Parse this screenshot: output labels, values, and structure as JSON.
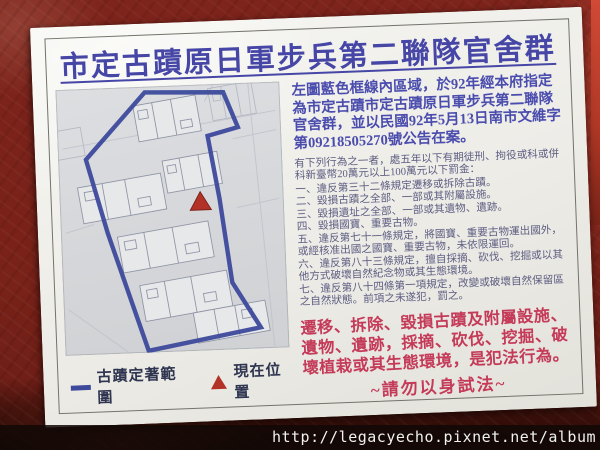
{
  "sign": {
    "title": "市定古蹟原日軍步兵第二聯隊官舍群",
    "intro": "左圖藍色框線內區域，於92年經本府指定為市定古蹟市定古蹟原日軍步兵第二聯隊官舍群，並以民國92年5月13日南市文維字第09218505270號公告在案。",
    "penalty_intro": "有下列行為之一者，處五年以下有期徒刑、拘役或科或併科新臺幣20萬元以上100萬元以下罰金：",
    "penalty_items": [
      "一、違反第三十二條規定遷移或拆除古蹟。",
      "二、毀損古蹟之全部、一部或其附屬設施。",
      "三、毀損遺址之全部、一部或其遺物、遺跡。",
      "四、毀損國寶、重要古物。",
      "五、違反第七十一條規定，將國寶、重要古物運出國外，或經核准出國之國寶、重要古物，未依限運回。",
      "六、違反第八十三條規定，擅自採摘、砍伐、挖掘或以其他方式破壞自然紀念物或其生態環境。",
      "七、違反第八十四條第一項規定，改變或破壞自然保留區之自然狀態。前項之未遂犯，罰之。"
    ],
    "warning": "遷移、拆除、毀損古蹟及附屬設施、遺物、遺跡，採摘、砍伐、挖掘、破壞植栽或其生態環境，是犯法行為。",
    "warning_tail": "~請勿以身試法~",
    "legend": {
      "boundary_label": "古蹟定著範圍",
      "position_label": "現在位置"
    },
    "map": {
      "boundary_symbol": "blue-boundary-line",
      "position_symbol": "red-triangle-marker"
    },
    "colors": {
      "title_blue": "#4646a6",
      "intro_blue": "#4b4dae",
      "penalty_gray_indigo": "#5d5d82",
      "warning_red": "#c43a58",
      "boundary_blue": "#3d4a9c",
      "marker_red": "#b23228",
      "wall_red": "#7d241c",
      "sign_white": "#f2f1ec"
    }
  },
  "watermark": "http://legacyecho.pixnet.net/album"
}
